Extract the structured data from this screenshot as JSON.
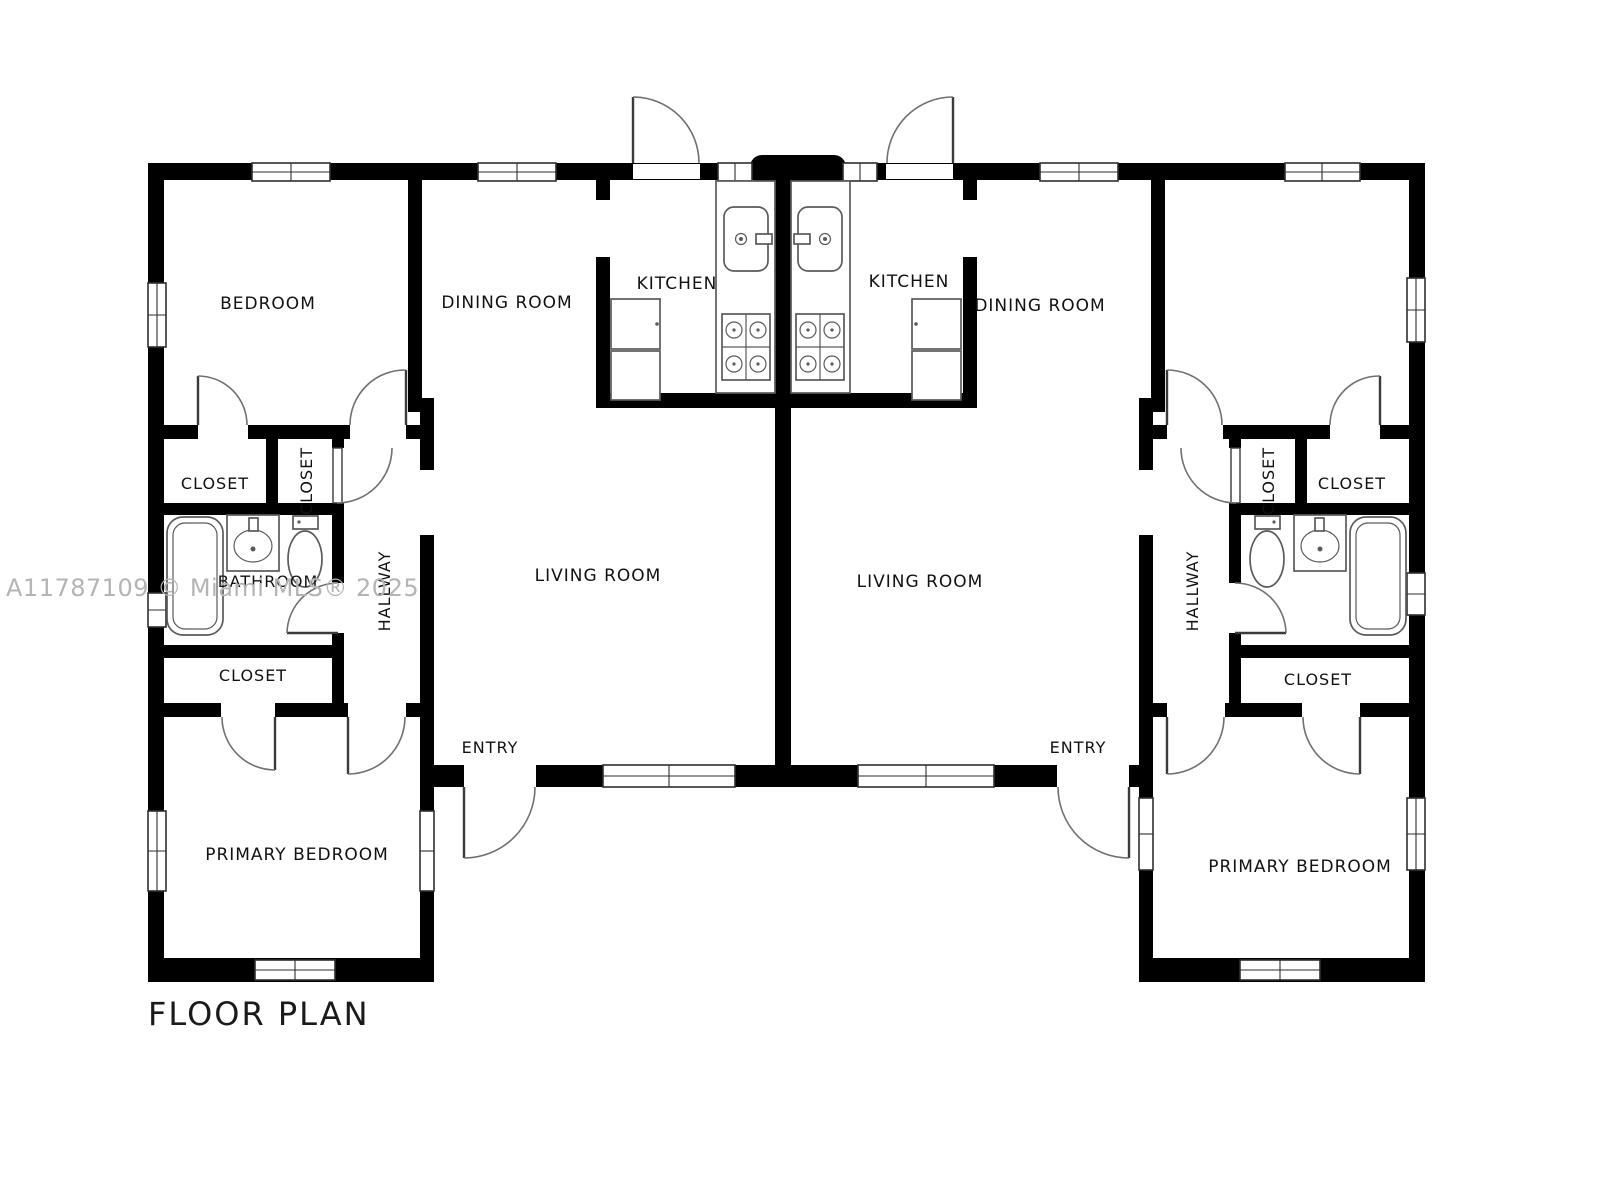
{
  "page": {
    "background": "#ffffff"
  },
  "title": {
    "text": "FLOOR PLAN"
  },
  "watermark": {
    "text": "A11787109 © Miami MLS® 2025",
    "color": "#b4b4b4"
  },
  "colors": {
    "wall": "#000000",
    "door_line": "#707070",
    "fixture_line": "#5a5a5a",
    "window_frame": "#2f2f2f",
    "label": "#111111",
    "background": "#ffffff"
  },
  "units": {
    "left": {
      "bedroom": "BEDROOM",
      "dining_room": "DINING ROOM",
      "kitchen": "KITCHEN",
      "living_room": "LIVING ROOM",
      "closet_upper": "CLOSET",
      "closet_side": "CLOSET",
      "bathroom": "BATHROOM",
      "hallway": "HALLWAY",
      "closet_lower": "CLOSET",
      "primary_bedroom": "PRIMARY BEDROOM",
      "entry": "ENTRY"
    },
    "right": {
      "kitchen": "KITCHEN",
      "dining_room": "DINING ROOM",
      "living_room": "LIVING ROOM",
      "closet_side": "CLOSET",
      "closet_upper": "CLOSET",
      "hallway": "HALLWAY",
      "closet_lower": "CLOSET",
      "primary_bedroom": "PRIMARY BEDROOM",
      "entry": "ENTRY"
    }
  }
}
